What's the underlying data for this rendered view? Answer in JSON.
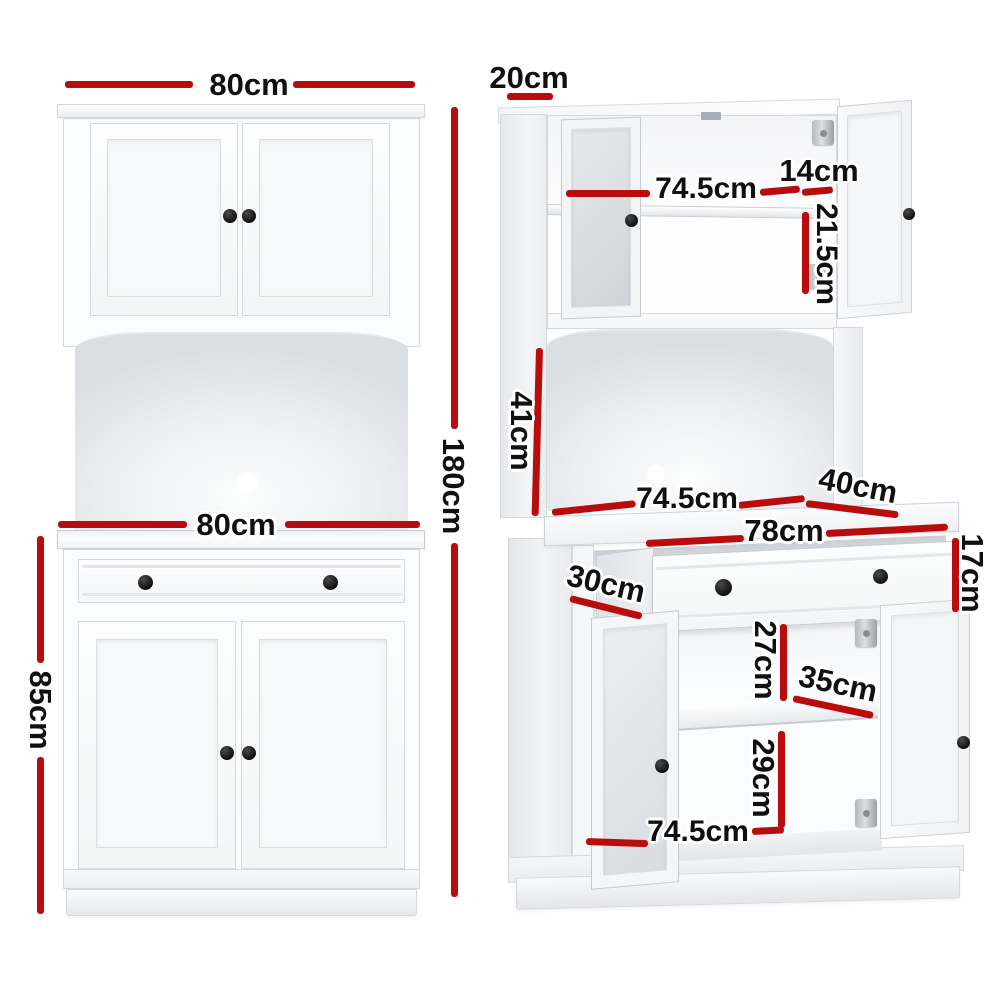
{
  "colors": {
    "dimension_red": "#b90c0c",
    "label_text": "#101010",
    "cabinet_white": "#ffffff"
  },
  "front_view": {
    "top_width": "80cm",
    "total_height": "180cm",
    "counter_width": "80cm",
    "lower_height": "85cm"
  },
  "open_view": {
    "top_depth": "20cm",
    "hutch_inner_width": "74.5cm",
    "hutch_door_width": "14cm",
    "hutch_shelf_height": "21.5cm",
    "alcove_height": "41cm",
    "alcove_width": "74.5cm",
    "counter_depth": "40cm",
    "drawer_width": "78cm",
    "drawer_height": "17cm",
    "drawer_depth": "30cm",
    "upper_compartment_height": "27cm",
    "shelf_depth": "35cm",
    "lower_compartment_height": "29cm",
    "base_inner_width": "74.5cm"
  }
}
